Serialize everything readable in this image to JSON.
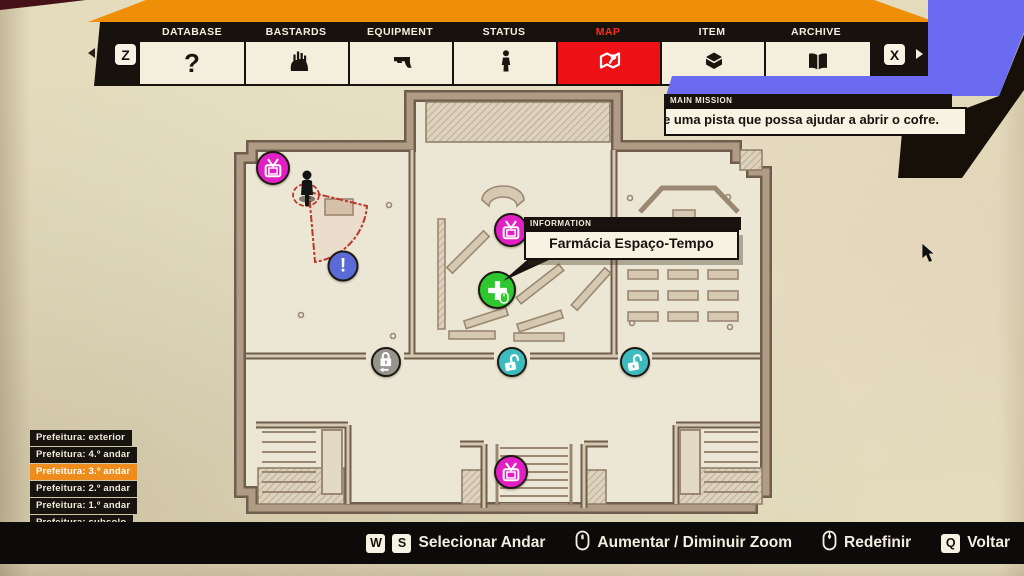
{
  "header": {
    "prev_key": "Z",
    "next_key": "X",
    "glyphs": {
      "database": "?"
    },
    "tabs": [
      {
        "label": "DATABASE",
        "icon": "question-mark-icon",
        "active": false
      },
      {
        "label": "BASTARDS",
        "icon": "zombie-hand-icon",
        "active": false
      },
      {
        "label": "EQUIPMENT",
        "icon": "gun-icon",
        "active": false
      },
      {
        "label": "STATUS",
        "icon": "person-icon",
        "active": false
      },
      {
        "label": "MAP",
        "icon": "map-marker-icon",
        "active": true
      },
      {
        "label": "ITEM",
        "icon": "item-box-icon",
        "active": false
      },
      {
        "label": "ARCHIVE",
        "icon": "book-icon",
        "active": false
      }
    ]
  },
  "mission": {
    "label": "MAIN MISSION",
    "text": "e uma pista que possa ajudar a abrir o cofre."
  },
  "tooltip": {
    "label": "INFORMATION",
    "text": "Farmácia Espaço-Tempo"
  },
  "floors": {
    "items": [
      {
        "label": "Prefeitura: exterior",
        "selected": false
      },
      {
        "label": "Prefeitura: 4.º andar",
        "selected": false
      },
      {
        "label": "Prefeitura: 3.º andar",
        "selected": true
      },
      {
        "label": "Prefeitura: 2.º andar",
        "selected": false
      },
      {
        "label": "Prefeitura: 1.º andar",
        "selected": false
      },
      {
        "label": "Prefeitura: subsolo",
        "selected": false
      }
    ]
  },
  "map": {
    "markers": [
      {
        "name": "shop-marker-top-left",
        "type": "tv-shop",
        "color": "#e11fc4"
      },
      {
        "name": "player-marker",
        "type": "player",
        "color": "#141414"
      },
      {
        "name": "objective-marker",
        "type": "exclamation",
        "glyph": "!",
        "color": "#5a6bd8"
      },
      {
        "name": "info-shop-marker",
        "type": "tv-shop",
        "color": "#e11fc4"
      },
      {
        "name": "pharmacy-marker",
        "type": "health-cross",
        "color": "#2ec82e"
      },
      {
        "name": "locked-door-marker",
        "type": "lock-closed",
        "color": "#97948e"
      },
      {
        "name": "unlocked-door-marker-1",
        "type": "lock-open",
        "color": "#3cbcbe"
      },
      {
        "name": "unlocked-door-marker-2",
        "type": "lock-open",
        "color": "#3cbcbe"
      },
      {
        "name": "shop-marker-bottom",
        "type": "tv-shop",
        "color": "#e11fc4"
      }
    ]
  },
  "footer": {
    "items": [
      {
        "keys": [
          "W",
          "S"
        ],
        "label": "Selecionar Andar"
      },
      {
        "icon": "mouse-scroll-icon",
        "label": "Aumentar / Diminuir Zoom"
      },
      {
        "icon": "mouse-middle-icon",
        "label": "Redefinir"
      },
      {
        "keys": [
          "Q"
        ],
        "label": "Voltar"
      }
    ]
  },
  "colors": {
    "accent_orange": "#ef8f07",
    "tab_active_red": "#ed1014",
    "banner_blue": "#6b6bf2",
    "selected_orange": "#ee8d1d",
    "paper": "#e4dcbd",
    "magenta": "#e11fc4",
    "green": "#2ec82e",
    "teal": "#3cbcbe",
    "marker_blue": "#5a6bd8",
    "lock_gray": "#97948e"
  }
}
